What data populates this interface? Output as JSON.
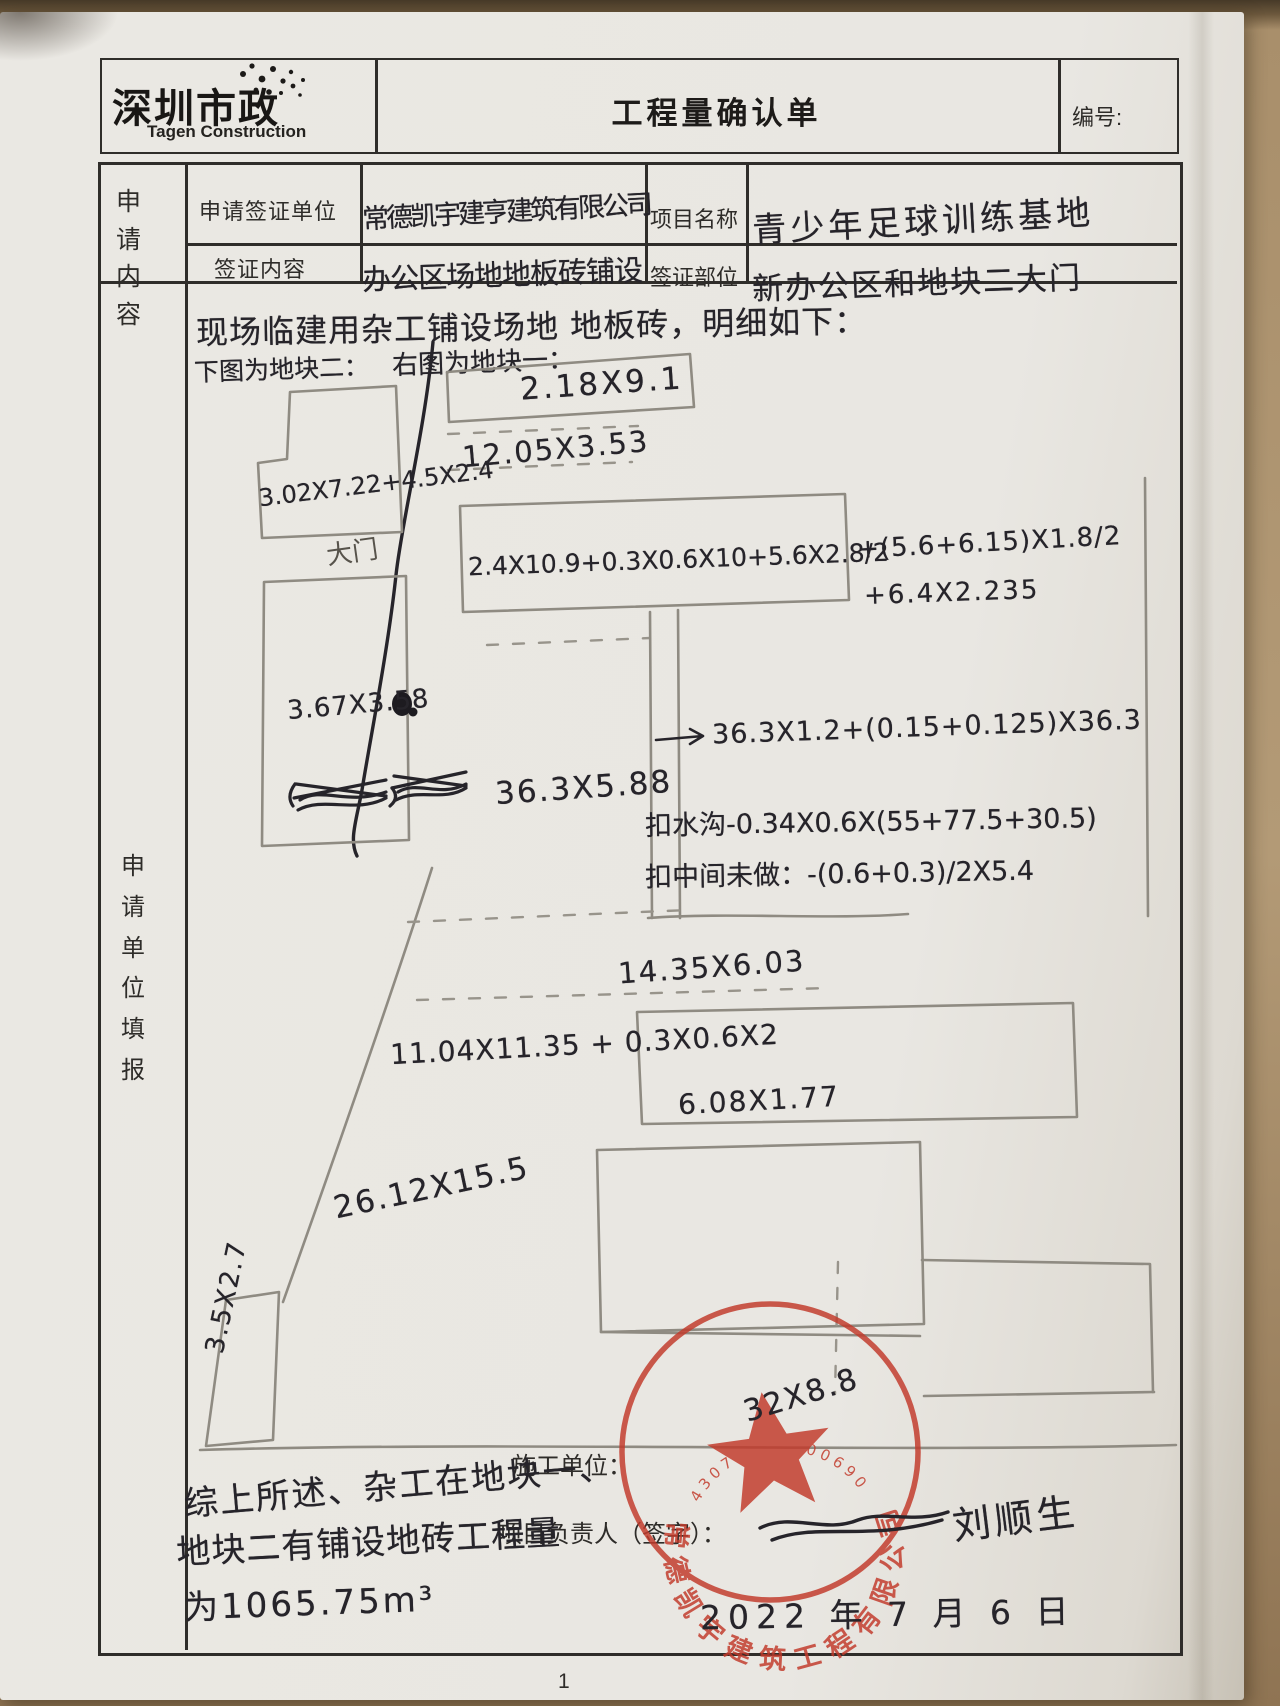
{
  "header": {
    "logo_cn": "深圳市政",
    "logo_en": "Tagen Construction",
    "title": "工程量确认单",
    "no_label": "编号:"
  },
  "form": {
    "section_label": "申请内容",
    "filler_label": "申请单位填报",
    "apply_unit_label": "申请签证单位",
    "apply_unit_value": "常德凯宇建亨建筑有限公司",
    "project_label": "项目名称",
    "project_value": "青少年足球训练基地",
    "content_label": "签证内容",
    "content_value": "办公区场地地板砖铺设",
    "part_label": "签证部位",
    "part_value": "新办公区和地块二大门"
  },
  "notes": {
    "intro": "现场临建用杂工铺设场地 地板砖，明细如下：",
    "left_block": "下图为地块二：",
    "right_block": "右图为地块一："
  },
  "measurements": {
    "m1": "2.18X9.1",
    "m2": "12.05X3.53",
    "m3": "3.02X7.22+4.5X2.4",
    "m4": "大门",
    "m5": "2.4X10.9+0.3X0.6X10+5.6X2.8/2",
    "m6": "+(5.6+6.15)X1.8/2",
    "m7": "+6.4X2.235",
    "m8": "3.67X3.58",
    "m9": "36.3X5.88",
    "m10": "36.3X1.2+(0.15+0.125)X36.3",
    "m11": "扣水沟-0.34X0.6X(55+77.5+30.5)",
    "m12": "扣中间未做：-(0.6+0.3)/2X5.4",
    "m13": "14.35X6.03",
    "m14": "11.04X11.35 + 0.3X0.6X2",
    "m15": "6.08X1.77",
    "m16": "26.12X15.5",
    "m17": "3.5X2.7",
    "m18": "32X8.8"
  },
  "summary": {
    "line1": "综上所述、杂工在地块一、",
    "line2": "地块二有铺设地砖工程量",
    "line3": "为1065.75m³"
  },
  "signoff": {
    "builder_label": "施工单位：",
    "manager_label": "项目负责人（签字）：",
    "signature": "刘顺生",
    "date": "2022 年 7 月 6 日"
  },
  "stamp": {
    "company": "常德凯宇建筑工程有限公司",
    "serial": "43072110000690",
    "color": "#c23a2b"
  },
  "page": {
    "number": "1"
  },
  "colors": {
    "ink": "#26242a",
    "pencil": "#8f8b82",
    "stamp_red": "#c23a2b"
  }
}
